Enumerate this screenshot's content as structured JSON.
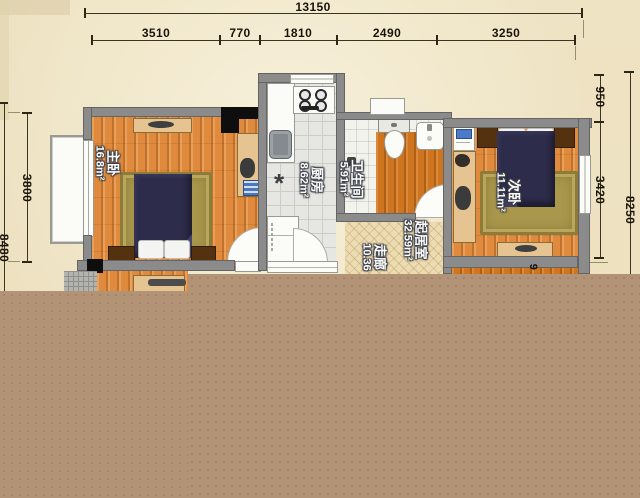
{
  "plan": {
    "rooms": {
      "master": {
        "name": "主卧",
        "area": "16.8m²"
      },
      "kitchen": {
        "name": "厨房",
        "area": "8.62m²"
      },
      "bath": {
        "name": "卫生间",
        "area": "5.91m²"
      },
      "living": {
        "name": "起居室",
        "area": "32.59m²"
      },
      "corridor": {
        "name": "走廊",
        "area": "10.36"
      },
      "second": {
        "name": "次卧",
        "area": "11.11m²"
      }
    },
    "kitchen_drain_symbol": "*"
  },
  "dimensions": {
    "total_width": "13150",
    "top_segments": [
      "3510",
      "770",
      "1810",
      "2490",
      "3250"
    ],
    "left_height": "3800",
    "left_total": "8480",
    "right_top": "950",
    "right_mid": "3420",
    "right_total": "8250",
    "partial_digit": "9"
  },
  "colors": {
    "background": "#efe4c5",
    "overlay_brown": "#b39376",
    "wall": "#8b8b8b",
    "wood_floor": "#dd8436",
    "rug": "#a9974c"
  }
}
